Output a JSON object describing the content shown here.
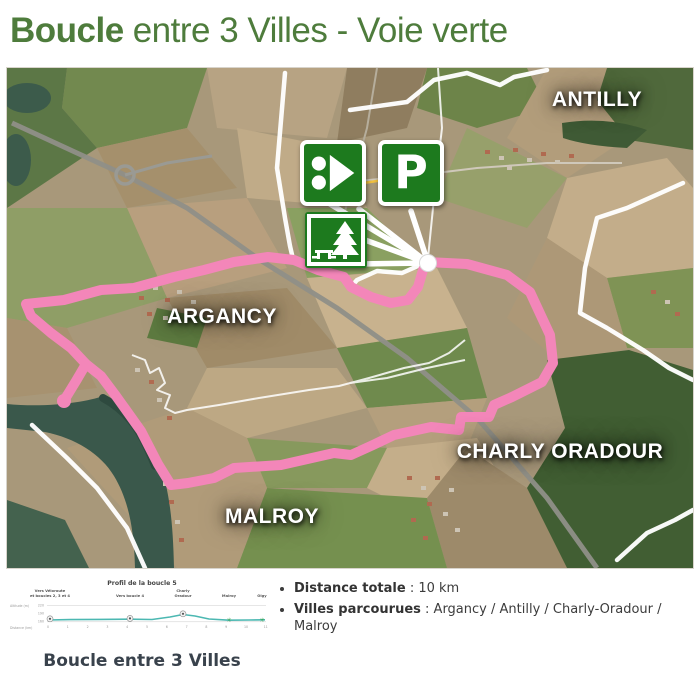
{
  "header": {
    "title_bold": "Boucle",
    "title_rest": "entre 3 Villes - Voie verte"
  },
  "map": {
    "town_labels": [
      {
        "text": "ANTILLY"
      },
      {
        "text": "ARGANCY"
      },
      {
        "text": "CHARLY ORADOUR"
      },
      {
        "text": "MALROY"
      }
    ],
    "icons": [
      {
        "name": "route-start-icon"
      },
      {
        "name": "parking-icon",
        "letter": "P"
      },
      {
        "name": "picnic-area-icon"
      }
    ],
    "route_color": "#f386b9"
  },
  "profile": {
    "title": "Profil de la boucle 5",
    "caption": "Boucle entre 3 Villes",
    "ylabel": "Altitude (m)",
    "xlabel": "Distance (km)",
    "waypoints": {
      "start1": "Vers Véloroute",
      "start2": "et boucles 2, 3 et 4",
      "mid": "Vers boucle 4",
      "charly1": "Charly",
      "charly2": "Oradour",
      "malroy": "Malroy",
      "olgy": "Olgy"
    },
    "yticks": [
      "220",
      "190",
      "160"
    ],
    "xticks": [
      "0",
      "1",
      "2",
      "3",
      "4",
      "5",
      "6",
      "7",
      "8",
      "9",
      "10",
      "11"
    ]
  },
  "details": {
    "items": [
      {
        "label": "Distance totale",
        "sep": " : ",
        "value": "10 km"
      },
      {
        "label": "Villes parcourues",
        "sep": " : ",
        "value": "Argancy / Antilly / Charly-Oradour / Malroy"
      }
    ]
  },
  "chart_data": {
    "type": "line",
    "title": "Profil de la boucle 5",
    "xlabel": "Distance (km)",
    "ylabel": "Altitude (m)",
    "x": [
      0,
      1,
      2,
      3,
      4,
      5,
      6,
      7,
      8,
      9,
      10,
      11
    ],
    "y": [
      165,
      164,
      163,
      163,
      164,
      168,
      183,
      176,
      163,
      160,
      160,
      161
    ],
    "xlim": [
      0,
      11
    ],
    "ylim": [
      160,
      220
    ],
    "annotations": [
      "Vers Véloroute et boucles 2, 3 et 4",
      "Vers boucle 4",
      "Charly Oradour",
      "Malroy",
      "Olgy"
    ],
    "line_color": "#4cb8b2"
  },
  "colors": {
    "accent_green": "#4e7c3c",
    "route_pink": "#f386b9",
    "icon_green": "#1d7a1e",
    "profile_line": "#4cb8b2"
  }
}
